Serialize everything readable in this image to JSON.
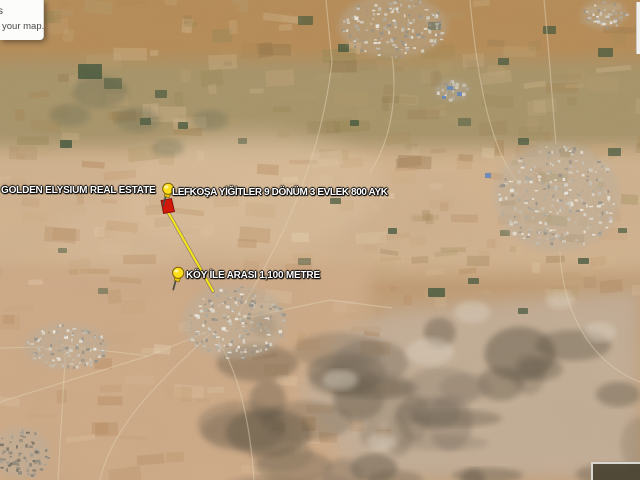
{
  "view": {
    "type": "satellite-map"
  },
  "tooltip": {
    "fragment": "s",
    "text": "your map."
  },
  "labels": {
    "brand": "GOLDEN ELYSIUM REAL ESTATE",
    "listing": "LEFKOŞA YİĞİTLER 9 DÖNÜM 3 EVLEK 800 AYK",
    "distance": "KÖY İLE ARASI 1,100 METRE"
  },
  "markers": {
    "listing_pin": {
      "icon": "yellow-pushpin"
    },
    "distance_pin": {
      "icon": "yellow-pushpin"
    },
    "parcel": {
      "shape": "red-quadrilateral",
      "color": "#d2170b"
    },
    "measure_line": {
      "color": "#f4e41c"
    }
  },
  "colors": {
    "terrain_tan": "#c29d74",
    "terrain_olive": "#a29366",
    "terrain_pink": "#d8b995",
    "rocky_gray": "#c6b19b",
    "pin_yellow": "#ffdf1b",
    "parcel_red": "#d2170b",
    "line_yellow": "#f4e41c"
  }
}
